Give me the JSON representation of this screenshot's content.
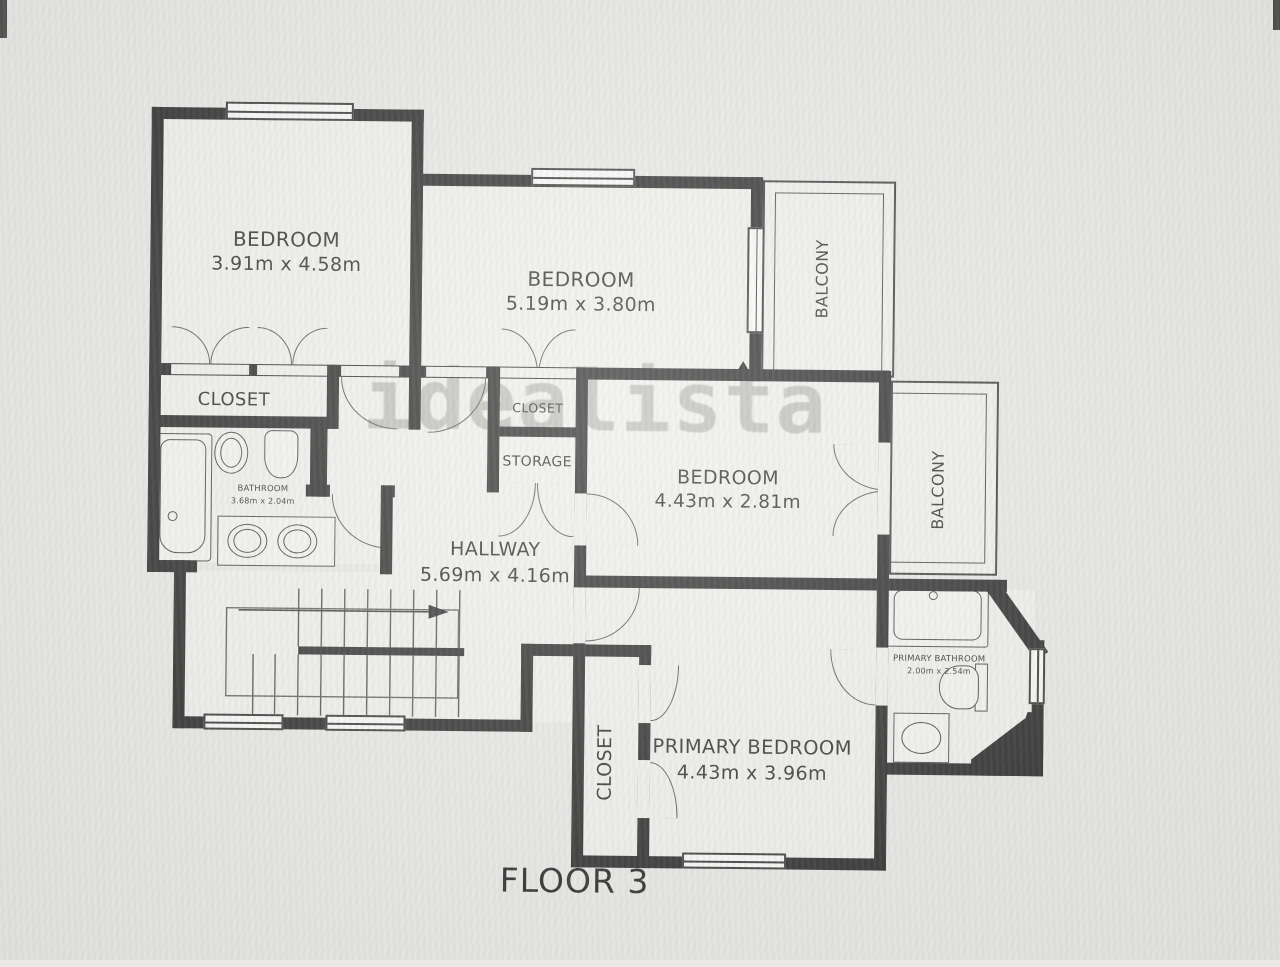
{
  "photo": {
    "floor_label": "FLOOR 3",
    "watermark": "idealista",
    "wall_color": "#1b1b1b",
    "paper_color": "#f2f1ed"
  },
  "rooms": {
    "bedroom_top_left": {
      "name": "BEDROOM",
      "dims": "3.91m x 4.58m"
    },
    "bedroom_top_middle": {
      "name": "BEDROOM",
      "dims": "5.19m x 3.80m"
    },
    "bedroom_middle_right": {
      "name": "BEDROOM",
      "dims": "4.43m x 2.81m"
    },
    "primary_bedroom": {
      "name": "PRIMARY BEDROOM",
      "dims": "4.43m x 3.96m"
    },
    "hallway": {
      "name": "HALLWAY",
      "dims": "5.69m x 4.16m"
    },
    "bathroom": {
      "name": "BATHROOM",
      "dims": "3.68m x 2.04m"
    },
    "primary_bathroom": {
      "name": "PRIMARY BATHROOM",
      "dims": "2.00m x 2.54m"
    },
    "closet_left": {
      "name": "CLOSET"
    },
    "closet_middle": {
      "name": "CLOSET"
    },
    "storage": {
      "name": "STORAGE"
    },
    "closet_primary": {
      "name": "CLOSET"
    },
    "balcony_top": {
      "name": "BALCONY"
    },
    "balcony_right": {
      "name": "BALCONY"
    }
  }
}
